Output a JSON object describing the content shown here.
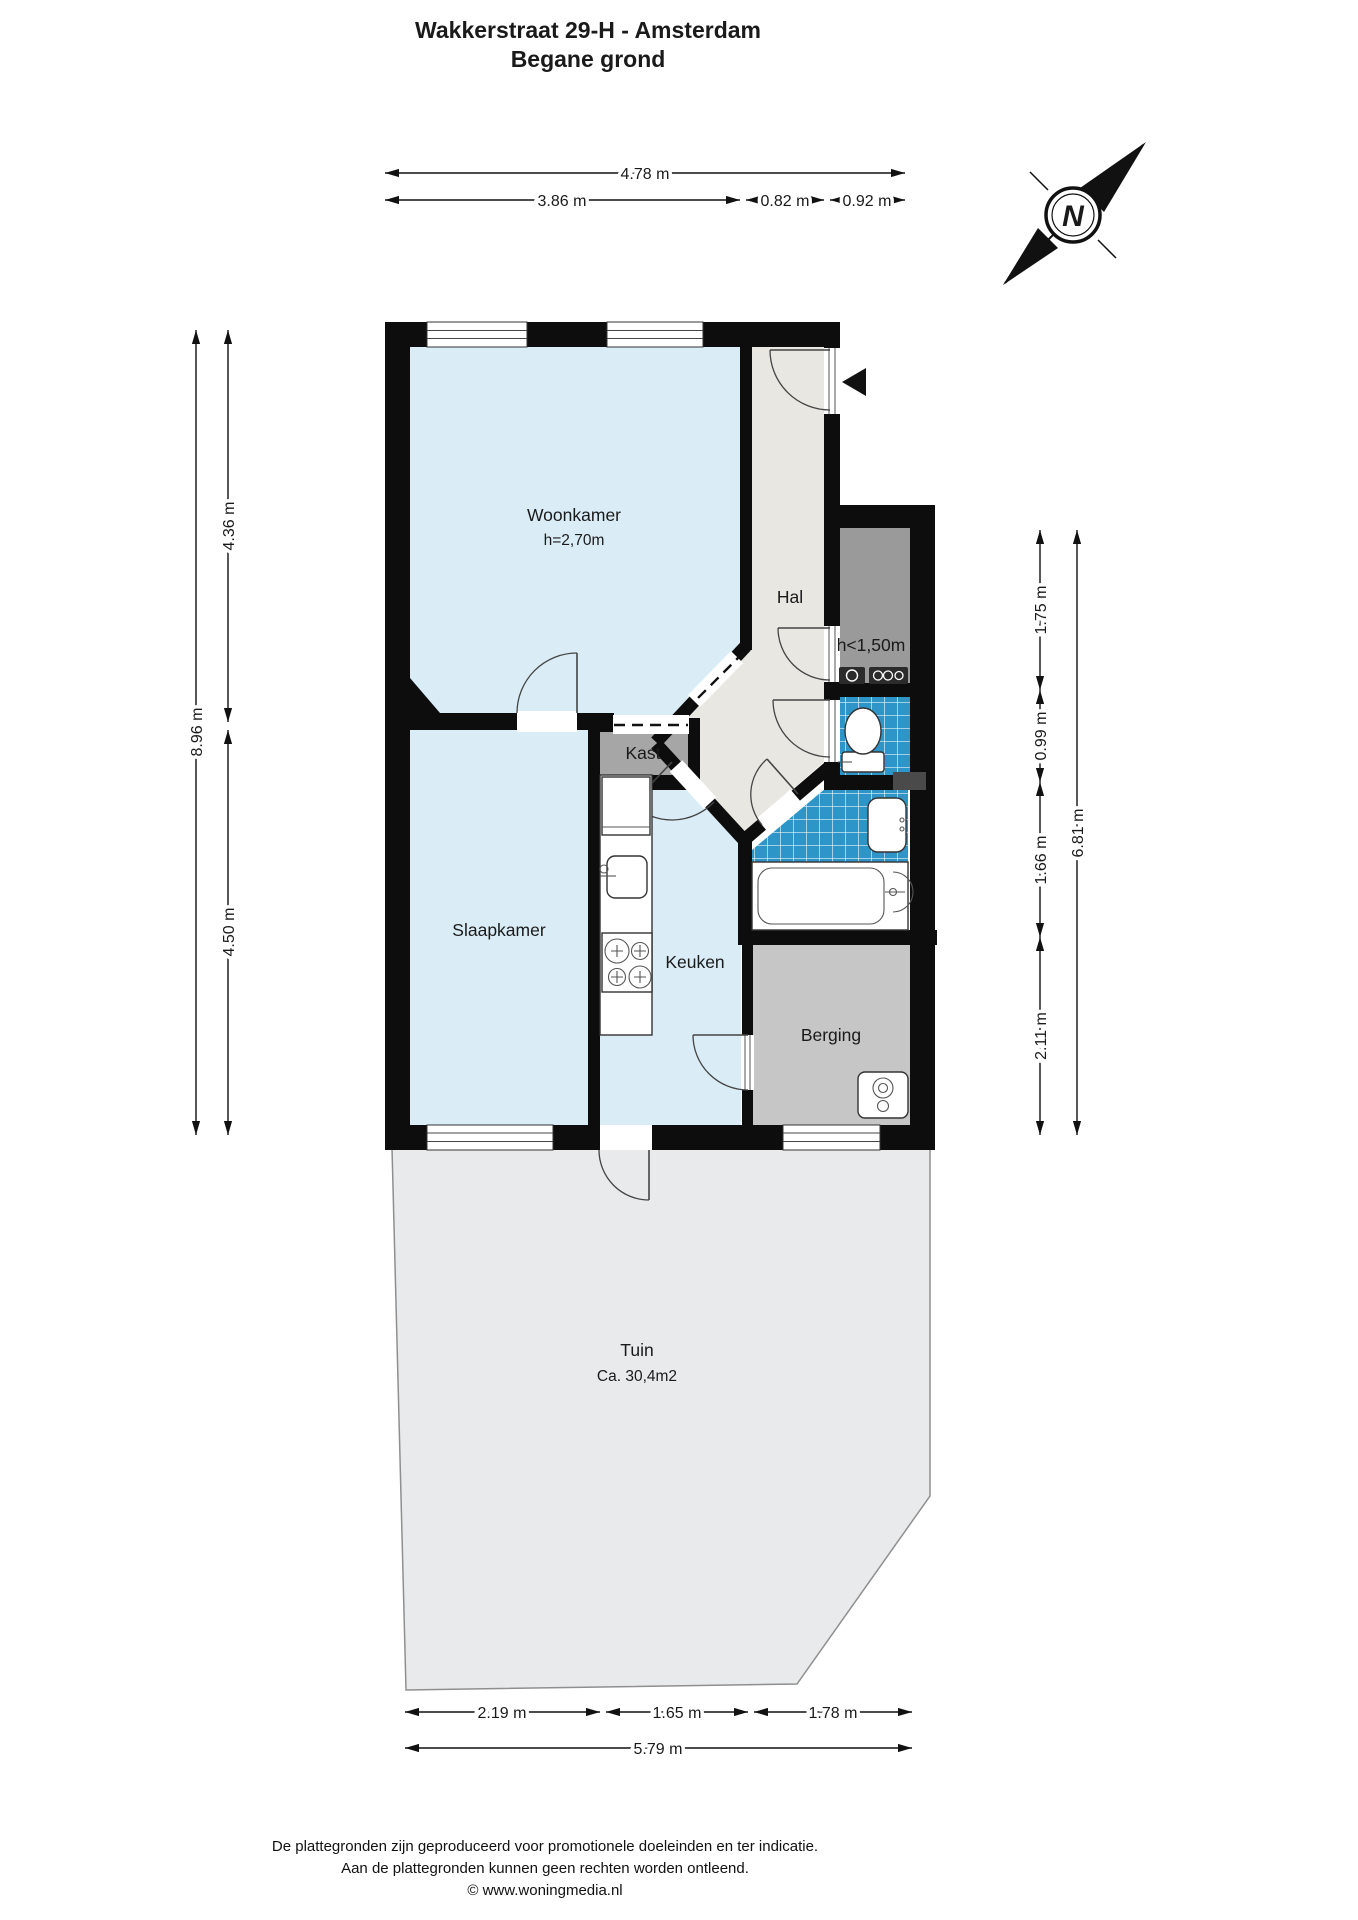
{
  "title": {
    "line1": "Wakkerstraat 29-H - Amsterdam",
    "line2": "Begane grond"
  },
  "compass": {
    "north_label": "N"
  },
  "rooms": {
    "woonkamer": {
      "label": "Woonkamer",
      "height_note": "h=2,70m"
    },
    "hal": {
      "label": "Hal"
    },
    "low_height_room": {
      "label": "h<1,50m"
    },
    "kast": {
      "label": "Kast"
    },
    "slaapkamer": {
      "label": "Slaapkamer"
    },
    "keuken": {
      "label": "Keuken"
    },
    "berging": {
      "label": "Berging"
    },
    "tuin": {
      "label": "Tuin",
      "area_note": "Ca. 30,4m2"
    }
  },
  "dimensions": {
    "top": {
      "total": "4.78 m",
      "segments": [
        "3.86 m",
        "0.82 m",
        "0.92 m"
      ]
    },
    "left": {
      "total": "8.96 m",
      "segments": [
        "4.36 m",
        "4.50 m"
      ]
    },
    "right": {
      "total": "6.81 m",
      "segments": [
        "1.75 m",
        "0.99 m",
        "1.66 m",
        "2.11 m"
      ]
    },
    "bottom": {
      "total": "5.79 m",
      "segments": [
        "2.19 m",
        "1.65 m",
        "1.78 m"
      ]
    }
  },
  "colors": {
    "wall": "#0d0d0d",
    "room_blue": "#daedf7",
    "hal_gray": "#e8e7e2",
    "tile_blue": "#2d95c8",
    "kast_gray": "#a6a6a6",
    "low_room_gray": "#9a9a9a",
    "berging_gray": "#c6c6c6",
    "tuin_gray": "#e9eaeb"
  },
  "footer": {
    "line1": "De plattegronden zijn geproduceerd voor promotionele doeleinden en ter indicatie.",
    "line2": "Aan de plattegronden kunnen geen rechten worden ontleend.",
    "line3": "© www.woningmedia.nl"
  }
}
